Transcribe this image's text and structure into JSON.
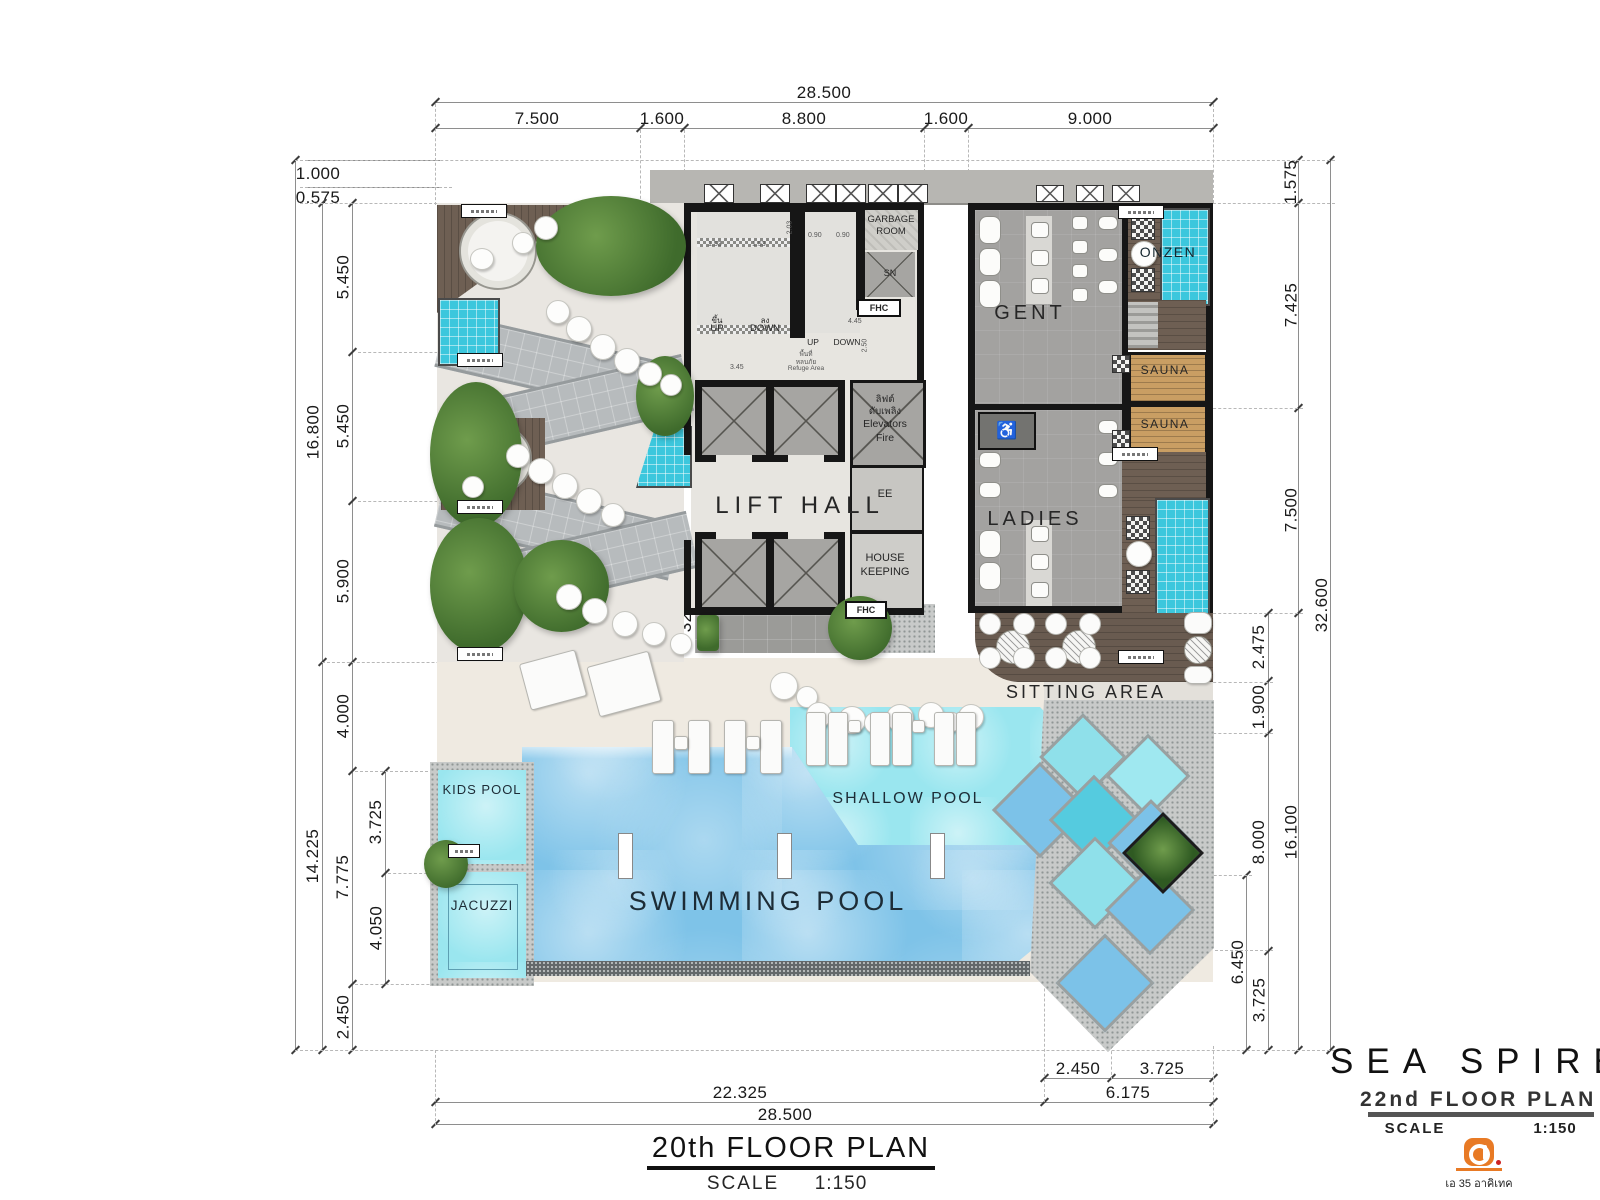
{
  "dims": {
    "top": {
      "overall": "28.500",
      "seg": [
        "7.500",
        "1.600",
        "8.800",
        "1.600",
        "9.000"
      ]
    },
    "left": {
      "h1": "1.000",
      "h2": "0.575",
      "a": "5.450",
      "b": "16.800",
      "c": "5.450",
      "d": "5.900",
      "total": "32.600",
      "e": "4.000",
      "f": "14.225",
      "g": "3.725",
      "h": "7.775",
      "i": "4.050",
      "j": "2.450"
    },
    "right": {
      "a": "1.575",
      "b": "7.425",
      "c": "7.500",
      "total": "32.600",
      "d": "2.475",
      "e": "1.900",
      "f": "8.000",
      "g": "16.100",
      "h": "6.450",
      "i": "3.725"
    },
    "bottom": {
      "a": "2.450",
      "b": "3.725",
      "c": "22.325",
      "d": "6.175",
      "total": "28.500"
    }
  },
  "core": {
    "gr1": "GARBAGE",
    "gr2": "ROOM",
    "sn": "SN",
    "fhc": "FHC",
    "stair1_up_th": "ขึ้น",
    "stair1_up": "UP",
    "stair1_down_th": "ลง",
    "stair1_down": "DOWN",
    "stair2_up": "UP",
    "stair2_down": "DOWN",
    "refuge_th1": "พื้นที่",
    "refuge_th2": "หลบภัย",
    "refuge_en": "Refuge Area",
    "fire_th1": "ลิฟต์",
    "fire_th2": "ดับเพลิง",
    "fire_en1": "Elevators",
    "fire_en2": "Fire",
    "lift_hall": "LIFT HALL",
    "ee": "EE",
    "hk1": "HOUSE",
    "hk2": "KEEPING",
    "d153a": "1.53",
    "d153b": "1.53",
    "d090a": "0.90",
    "d090b": "0.90",
    "d345": "3.45",
    "d203": "2.03",
    "d250": "2.50",
    "d445": "4.45"
  },
  "amenities": {
    "gent": "GENT",
    "ladies": "LADIES",
    "onzen": "ONZEN",
    "sauna1": "SAUNA",
    "sauna2": "SAUNA",
    "sitting": "SITTING AREA",
    "accessible": "♿"
  },
  "pools": {
    "kids": "KIDS POOL",
    "jacuzzi": "JACUZZI",
    "swimming": "SWIMMING POOL",
    "shallow": "SHALLOW POOL"
  },
  "drawing_title": {
    "title": "20th FLOOR PLAN",
    "scale_label": "SCALE",
    "scale_value": "1:150"
  },
  "title_block": {
    "project": "SEA SPIRE",
    "plan_name": "22nd FLOOR PLAN",
    "scale_label": "SCALE",
    "scale_value": "1:150",
    "firm_caption": "เอ 35 อาคิเทค"
  },
  "colors": {
    "pool_blue": "#7ec3e8",
    "pool_cyan": "#9ae6ef",
    "tile_teal": "#3cc7dd",
    "wood_brown": "#6e5f53",
    "sauna_wood": "#c99e63",
    "wall_black": "#161616",
    "accent_orange": "#e87a25"
  }
}
